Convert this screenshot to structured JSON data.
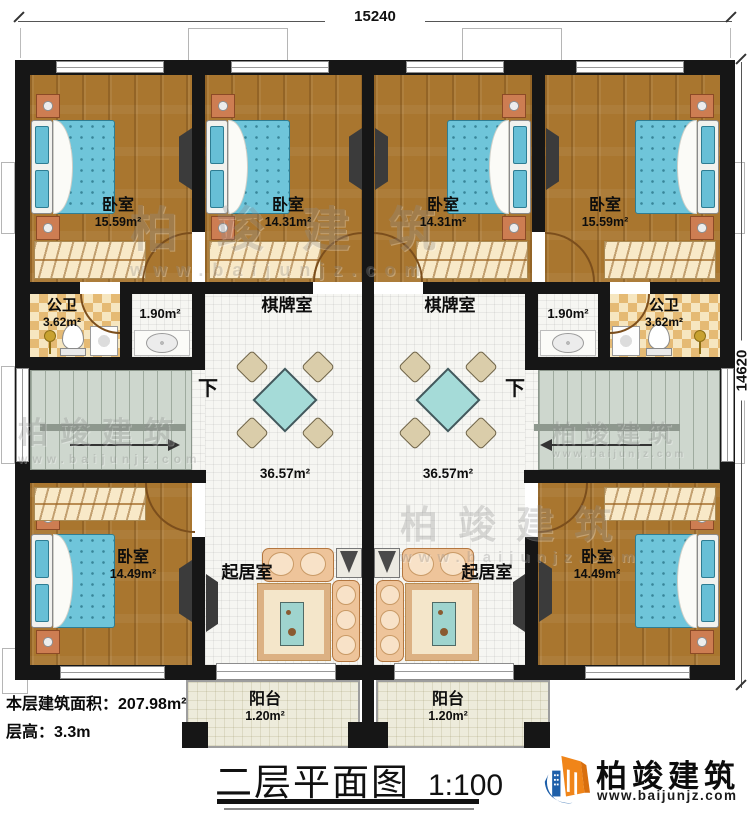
{
  "dimensions": {
    "top": "15240",
    "right": "14620"
  },
  "rooms": {
    "bedroom_top_left": {
      "name": "卧室",
      "area": "15.59m²"
    },
    "bedroom_top_mid_left": {
      "name": "卧室",
      "area": "14.31m²"
    },
    "bedroom_top_mid_right": {
      "name": "卧室",
      "area": "14.31m²"
    },
    "bedroom_top_right": {
      "name": "卧室",
      "area": "15.59m²"
    },
    "bath_left": {
      "name": "公卫",
      "area": "3.62m²"
    },
    "bath_right": {
      "name": "公卫",
      "area": "3.62m²"
    },
    "wash_left": {
      "area": "1.90m²"
    },
    "wash_right": {
      "area": "1.90m²"
    },
    "chess_left": {
      "name": "棋牌室",
      "area": "36.57m²"
    },
    "chess_right": {
      "name": "棋牌室",
      "area": "36.57m²"
    },
    "living_left": {
      "name": "起居室"
    },
    "living_right": {
      "name": "起居室"
    },
    "bedroom_bottom_left": {
      "name": "卧室",
      "area": "14.49m²"
    },
    "bedroom_bottom_right": {
      "name": "卧室",
      "area": "14.49m²"
    },
    "balcony_left": {
      "name": "阳台",
      "area": "1.20m²"
    },
    "balcony_right": {
      "name": "阳台",
      "area": "1.20m²"
    },
    "stairs_label": "下"
  },
  "footer": {
    "floor_area_label": "本层建筑面积：",
    "floor_area_value": "207.98m²",
    "floor_height_label": "层高：",
    "floor_height_value": "3.3m",
    "title": "二层平面图",
    "scale": "1:100"
  },
  "branding": {
    "company": "柏竣建筑",
    "website": "www.baijunjz.com",
    "logo_blue": "#1e5fa9",
    "logo_orange": "#f08519"
  },
  "colors": {
    "wall": "#161616",
    "wood": "#a9762f",
    "tile": "#f6f6f2",
    "checker": "#e5ba74",
    "stairs": "#ced7ce",
    "balcony": "#edebdb",
    "bed": "#6fc5da",
    "chess_table": "#a5dbd8",
    "sofa": "#eec49a"
  }
}
